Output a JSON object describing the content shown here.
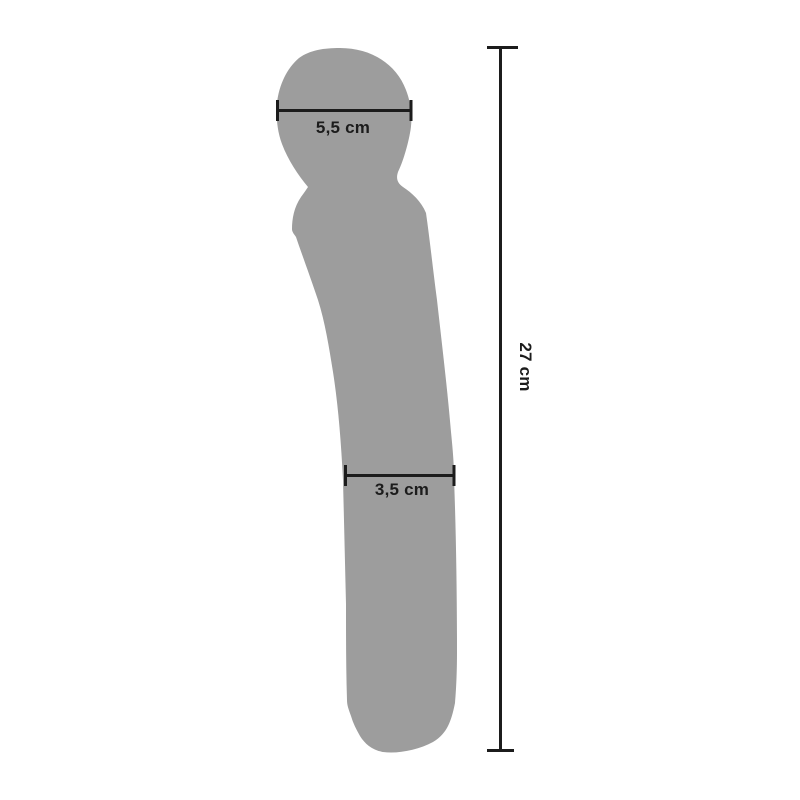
{
  "diagram": {
    "measurements": {
      "head_width": "5,5 cm",
      "shaft_width": "3,5 cm",
      "total_length": "27 cm"
    },
    "colors": {
      "background": "#ffffff",
      "silhouette": "#9d9d9d",
      "line": "#1c1c1c",
      "text": "#1c1c1c"
    }
  }
}
